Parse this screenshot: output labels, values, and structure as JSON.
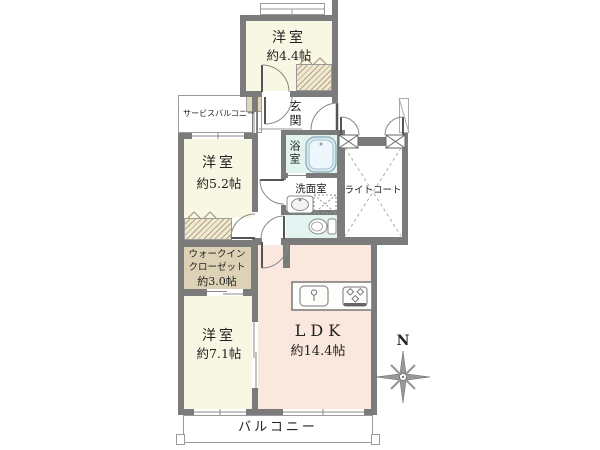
{
  "floorplan": {
    "rooms": {
      "bedroom_44": {
        "name": "洋室",
        "size": "約4.4帖"
      },
      "bedroom_52": {
        "name": "洋室",
        "size": "約5.2帖"
      },
      "bedroom_71": {
        "name": "洋室",
        "size": "約7.1帖"
      },
      "ldk": {
        "name": "LDK",
        "size": "約14.4帖"
      },
      "walk_in_closet": {
        "name_line1": "ウォークイン",
        "name_line2": "クローゼット",
        "size": "約3.0帖"
      },
      "entrance": {
        "name": "玄関"
      },
      "bathroom": {
        "name": "浴室"
      },
      "washroom": {
        "name": "洗面室"
      },
      "service_balcony": {
        "name": "サービスバルコニー"
      },
      "light_court": {
        "name": "ライトコート"
      },
      "balcony": {
        "name": "バルコニー"
      }
    },
    "compass": {
      "label": "N"
    },
    "colors": {
      "wall": "#7b7b7b",
      "room_cream": "#f8f7e4",
      "room_pink": "#fae8de",
      "closet_tan": "#ddd2b5",
      "closet_hatch_bg": "#f1e9d4",
      "wet_blue": "#e2f3f0",
      "tub_blue": "#d6edf5",
      "line_gray": "#9a9a9a"
    }
  }
}
